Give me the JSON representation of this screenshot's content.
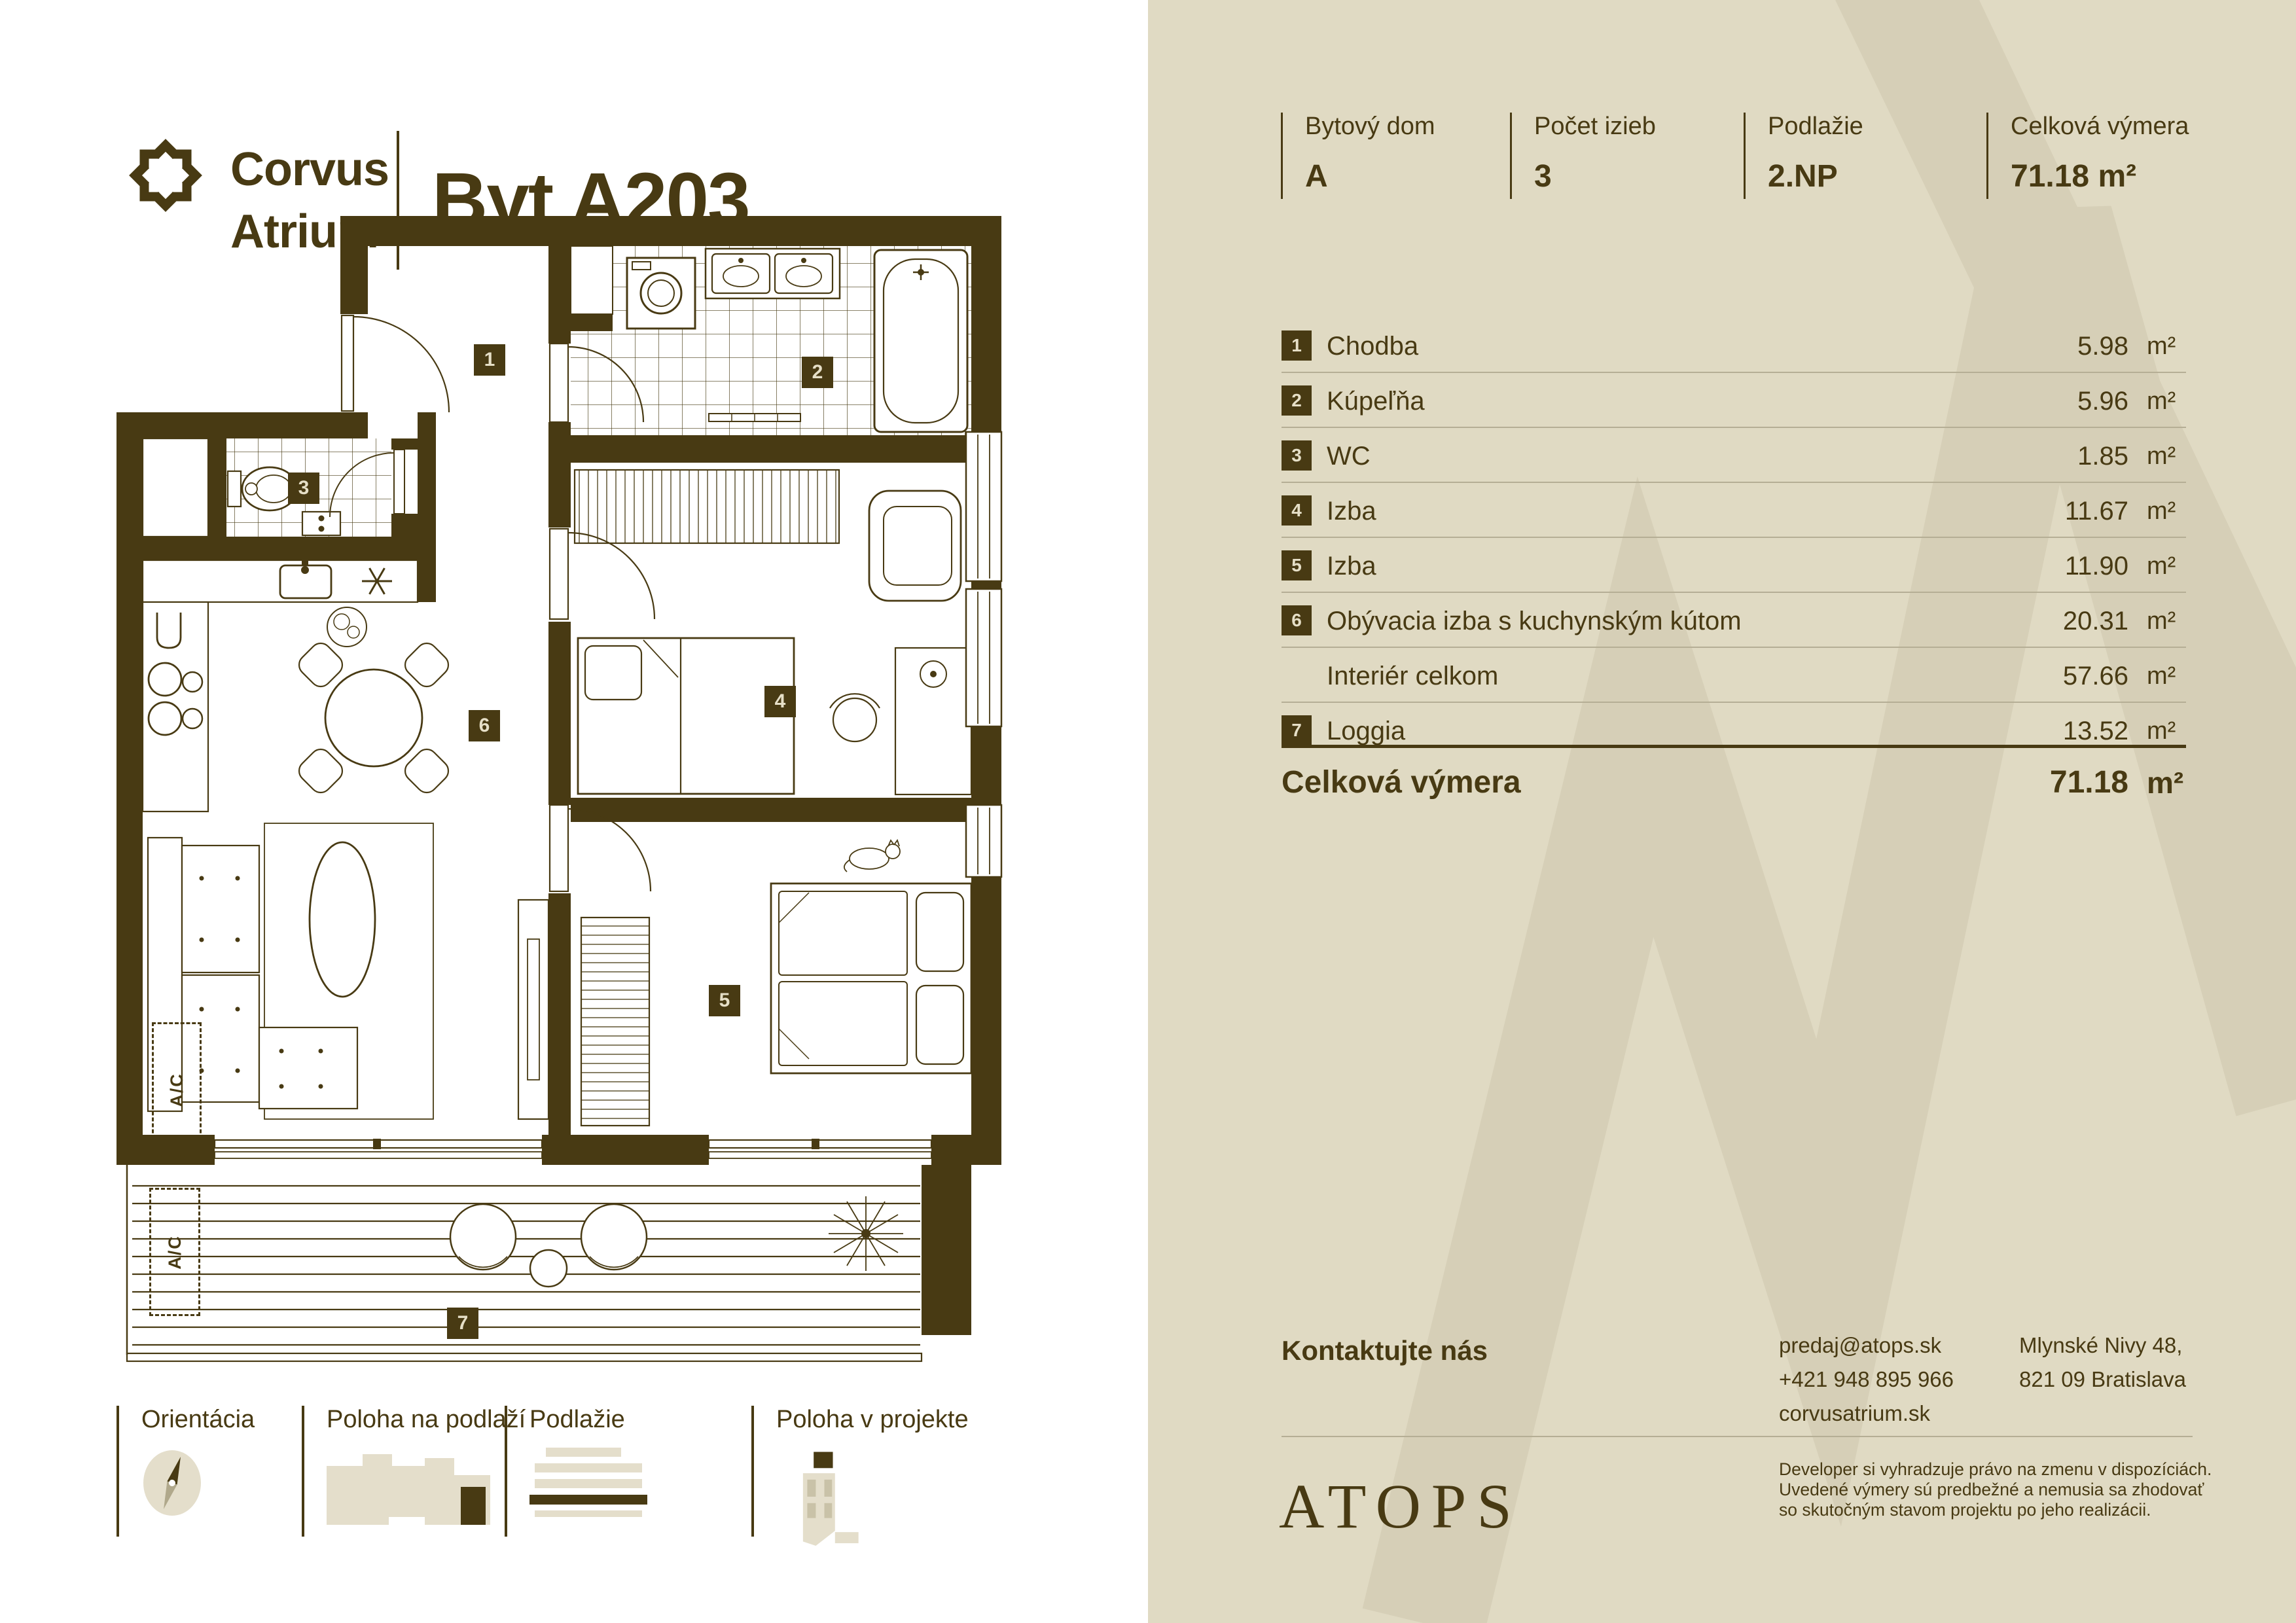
{
  "logo": {
    "line1": "Corvus",
    "line2": "Atrium"
  },
  "apartment": {
    "title": "Byt A203"
  },
  "header": {
    "columns": [
      {
        "label": "Bytový dom",
        "value": "A"
      },
      {
        "label": "Počet izieb",
        "value": "3"
      },
      {
        "label": "Podlažie",
        "value": "2.NP"
      },
      {
        "label": "Celková výmera",
        "value": "71.18 m²"
      }
    ]
  },
  "rooms_table": {
    "rows": [
      {
        "num": "1",
        "label": "Chodba",
        "area": "5.98",
        "unit": "m²"
      },
      {
        "num": "2",
        "label": "Kúpeľňa",
        "area": "5.96",
        "unit": "m²"
      },
      {
        "num": "3",
        "label": "WC",
        "area": "1.85",
        "unit": "m²"
      },
      {
        "num": "4",
        "label": "Izba",
        "area": "11.67",
        "unit": "m²"
      },
      {
        "num": "5",
        "label": "Izba",
        "area": "11.90",
        "unit": "m²"
      },
      {
        "num": "6",
        "label": "Obývacia izba s kuchynským kútom",
        "area": "20.31",
        "unit": "m²"
      },
      {
        "num": "",
        "label": "Interiér celkom",
        "area": "57.66",
        "unit": "m²"
      },
      {
        "num": "7",
        "label": "Loggia",
        "area": "13.52",
        "unit": "m²"
      }
    ],
    "total_label": "Celková výmera",
    "total_area": "71.18",
    "total_unit": "m²"
  },
  "plan": {
    "badges": [
      "1",
      "2",
      "3",
      "4",
      "5",
      "6",
      "7"
    ],
    "ac_label": "A/C"
  },
  "legend": {
    "items": [
      {
        "label": "Orientácia"
      },
      {
        "label": "Poloha na podlaží"
      },
      {
        "label": "Podlažie"
      },
      {
        "label": "Poloha v projekte"
      }
    ]
  },
  "contact": {
    "heading": "Kontaktujte nás",
    "email": "predaj@atops.sk",
    "phone": "+421 948 895 966",
    "web": "corvusatrium.sk",
    "address_line1": "Mlynské Nivy 48,",
    "address_line2": "821 09 Bratislava"
  },
  "footer": {
    "brand": "ATOPS",
    "disclaimer_line1": "Developer si vyhradzuje právo na zmenu v dispozíciách.",
    "disclaimer_line2": "Uvedené výmery sú predbežné a nemusia sa zhodovať",
    "disclaimer_line3": "so skutočným stavom projektu po jeho realizácii."
  },
  "colors": {
    "brand_brown": "#483a13",
    "panel_beige": "#e0dac3",
    "watermark_beige": "#d6cfb7",
    "badge_text": "#e6dfc7",
    "divider": "#b5ae95"
  }
}
